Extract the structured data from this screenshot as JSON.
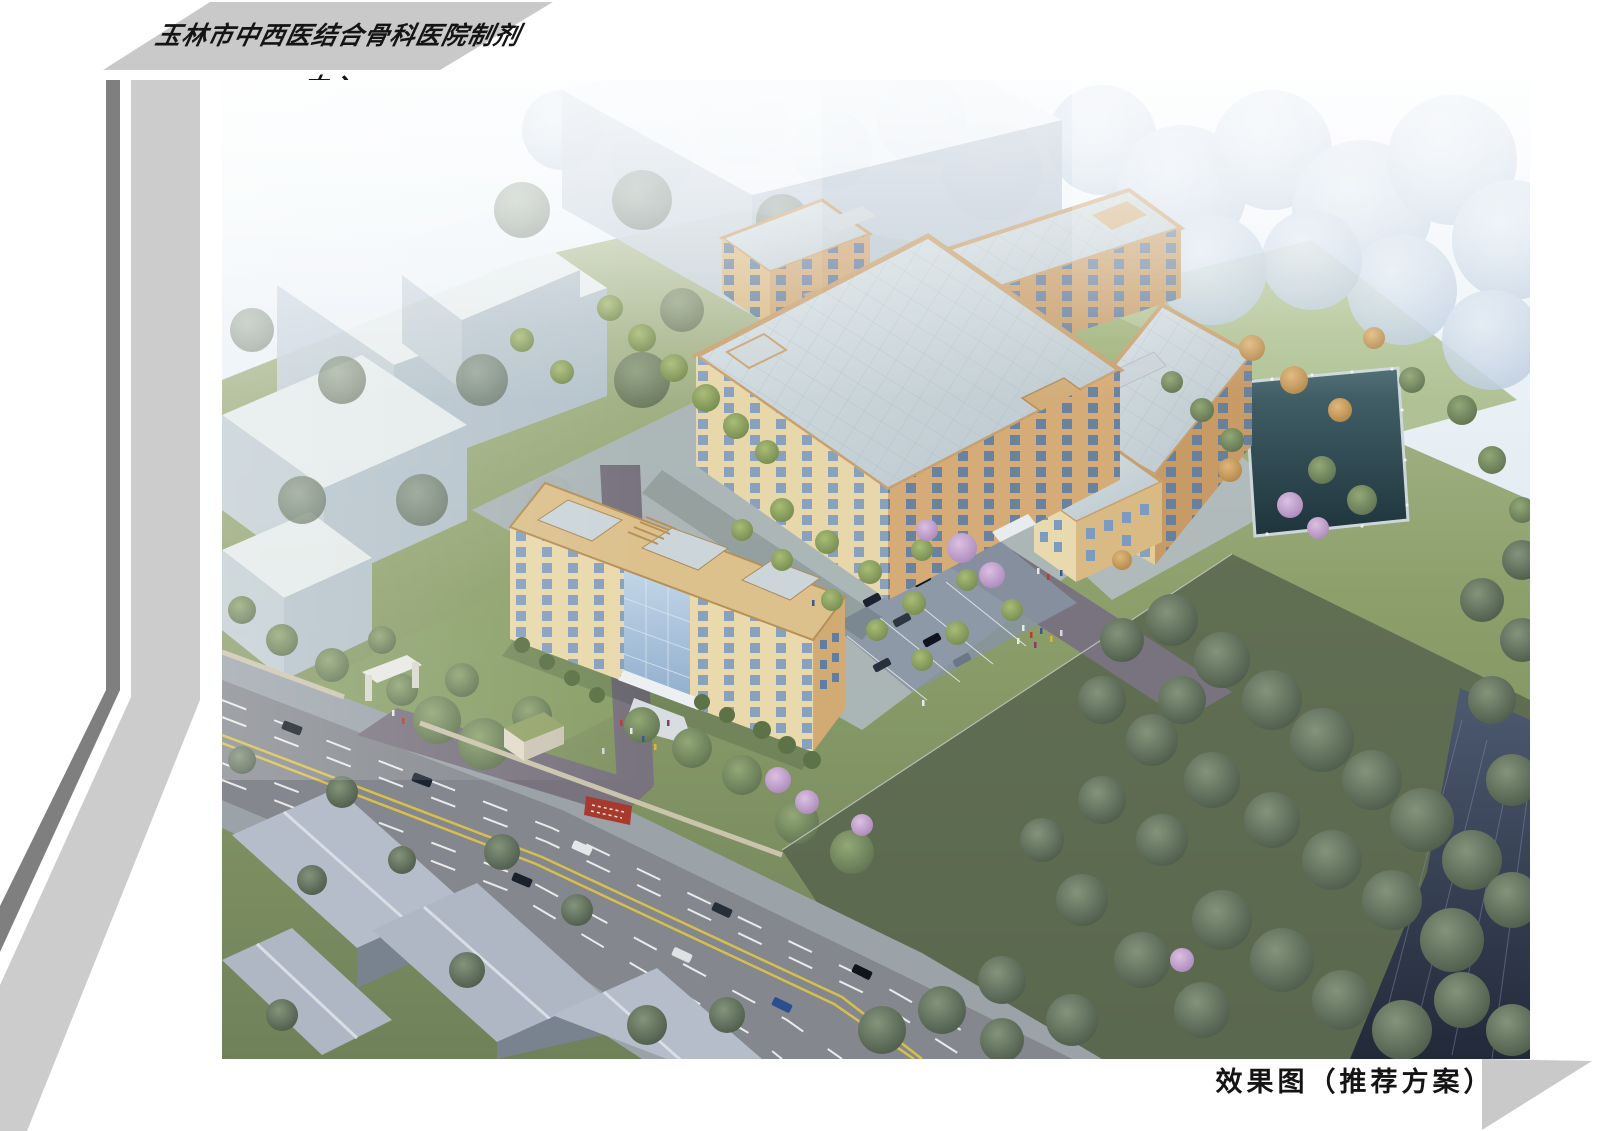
{
  "page": {
    "header": {
      "title": "玉林市中西医结合骨科医院制剂中心"
    },
    "caption": {
      "text": "效果图（推荐方案）"
    },
    "palette": {
      "banner_gray": "#c9c9c9",
      "bar_dark_gray": "#7f7f7f",
      "bar_light_gray": "#cccccc",
      "corner_triangle_gray": "#c9c9c9",
      "building_wall_tan_light": "#e8d7ab",
      "building_wall_tan_dark": "#d5ac77",
      "building_parapet_tan": "#c8a06d",
      "roof_blue_gray": "#c6d1d6",
      "window_glass_blue": "#7d9bc0",
      "curtain_wall_blue": "#9fb9d8",
      "road_gray": "#84878d",
      "lane_line_yellow": "#d6c04b",
      "lane_line_white": "#e9eaea",
      "pond_blue": "#2f4a54",
      "tree_green_bright": "#7fa05a",
      "tree_green_dark": "#4a5848",
      "blossom_purple": "#bb93c6",
      "autumn_orange": "#d9a469",
      "context_building_gray": "#c8d3de",
      "fog_blue": "#d4e2ee",
      "gate_sign_red": "#a73a2d"
    }
  }
}
